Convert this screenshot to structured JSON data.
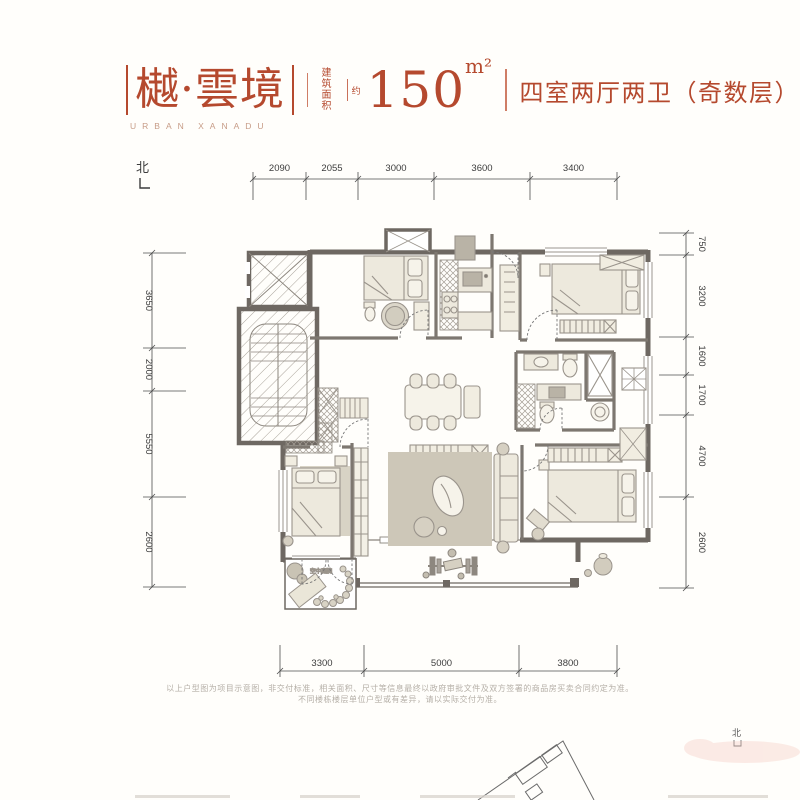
{
  "header": {
    "brand_name": "樾·雲境",
    "brand_subtitle": "URBAN XANADU",
    "area_label_line1": "建筑",
    "area_label_line2": "面积",
    "area_approx": "约",
    "area_value": "150",
    "area_unit": "m²",
    "unit_type": "四室两厅两卫（奇数层）"
  },
  "compass": {
    "top_label": "北",
    "bottom_label": "北"
  },
  "dimensions": {
    "top": [
      "2090",
      "2055",
      "3000",
      "3600",
      "3400"
    ],
    "left": [
      "3650",
      "2000",
      "5550",
      "2600"
    ],
    "right": [
      "750",
      "3200",
      "1600",
      "1700",
      "4700",
      "2600"
    ],
    "bottom": [
      "3300",
      "5000",
      "3800"
    ]
  },
  "plan": {
    "garden_label": "空中庭院"
  },
  "disclaimer": {
    "line1": "以上户型图为项目示意图，非交付标准，相关面积、尺寸等信息最终以政府审批文件及双方签署的商品房买卖合同约定为准。",
    "line2": "不同楼栋楼层单位户型或有差异，请以实际交付为准。"
  },
  "colors": {
    "accent": "#b5492e",
    "wall": "#6e6862"
  }
}
